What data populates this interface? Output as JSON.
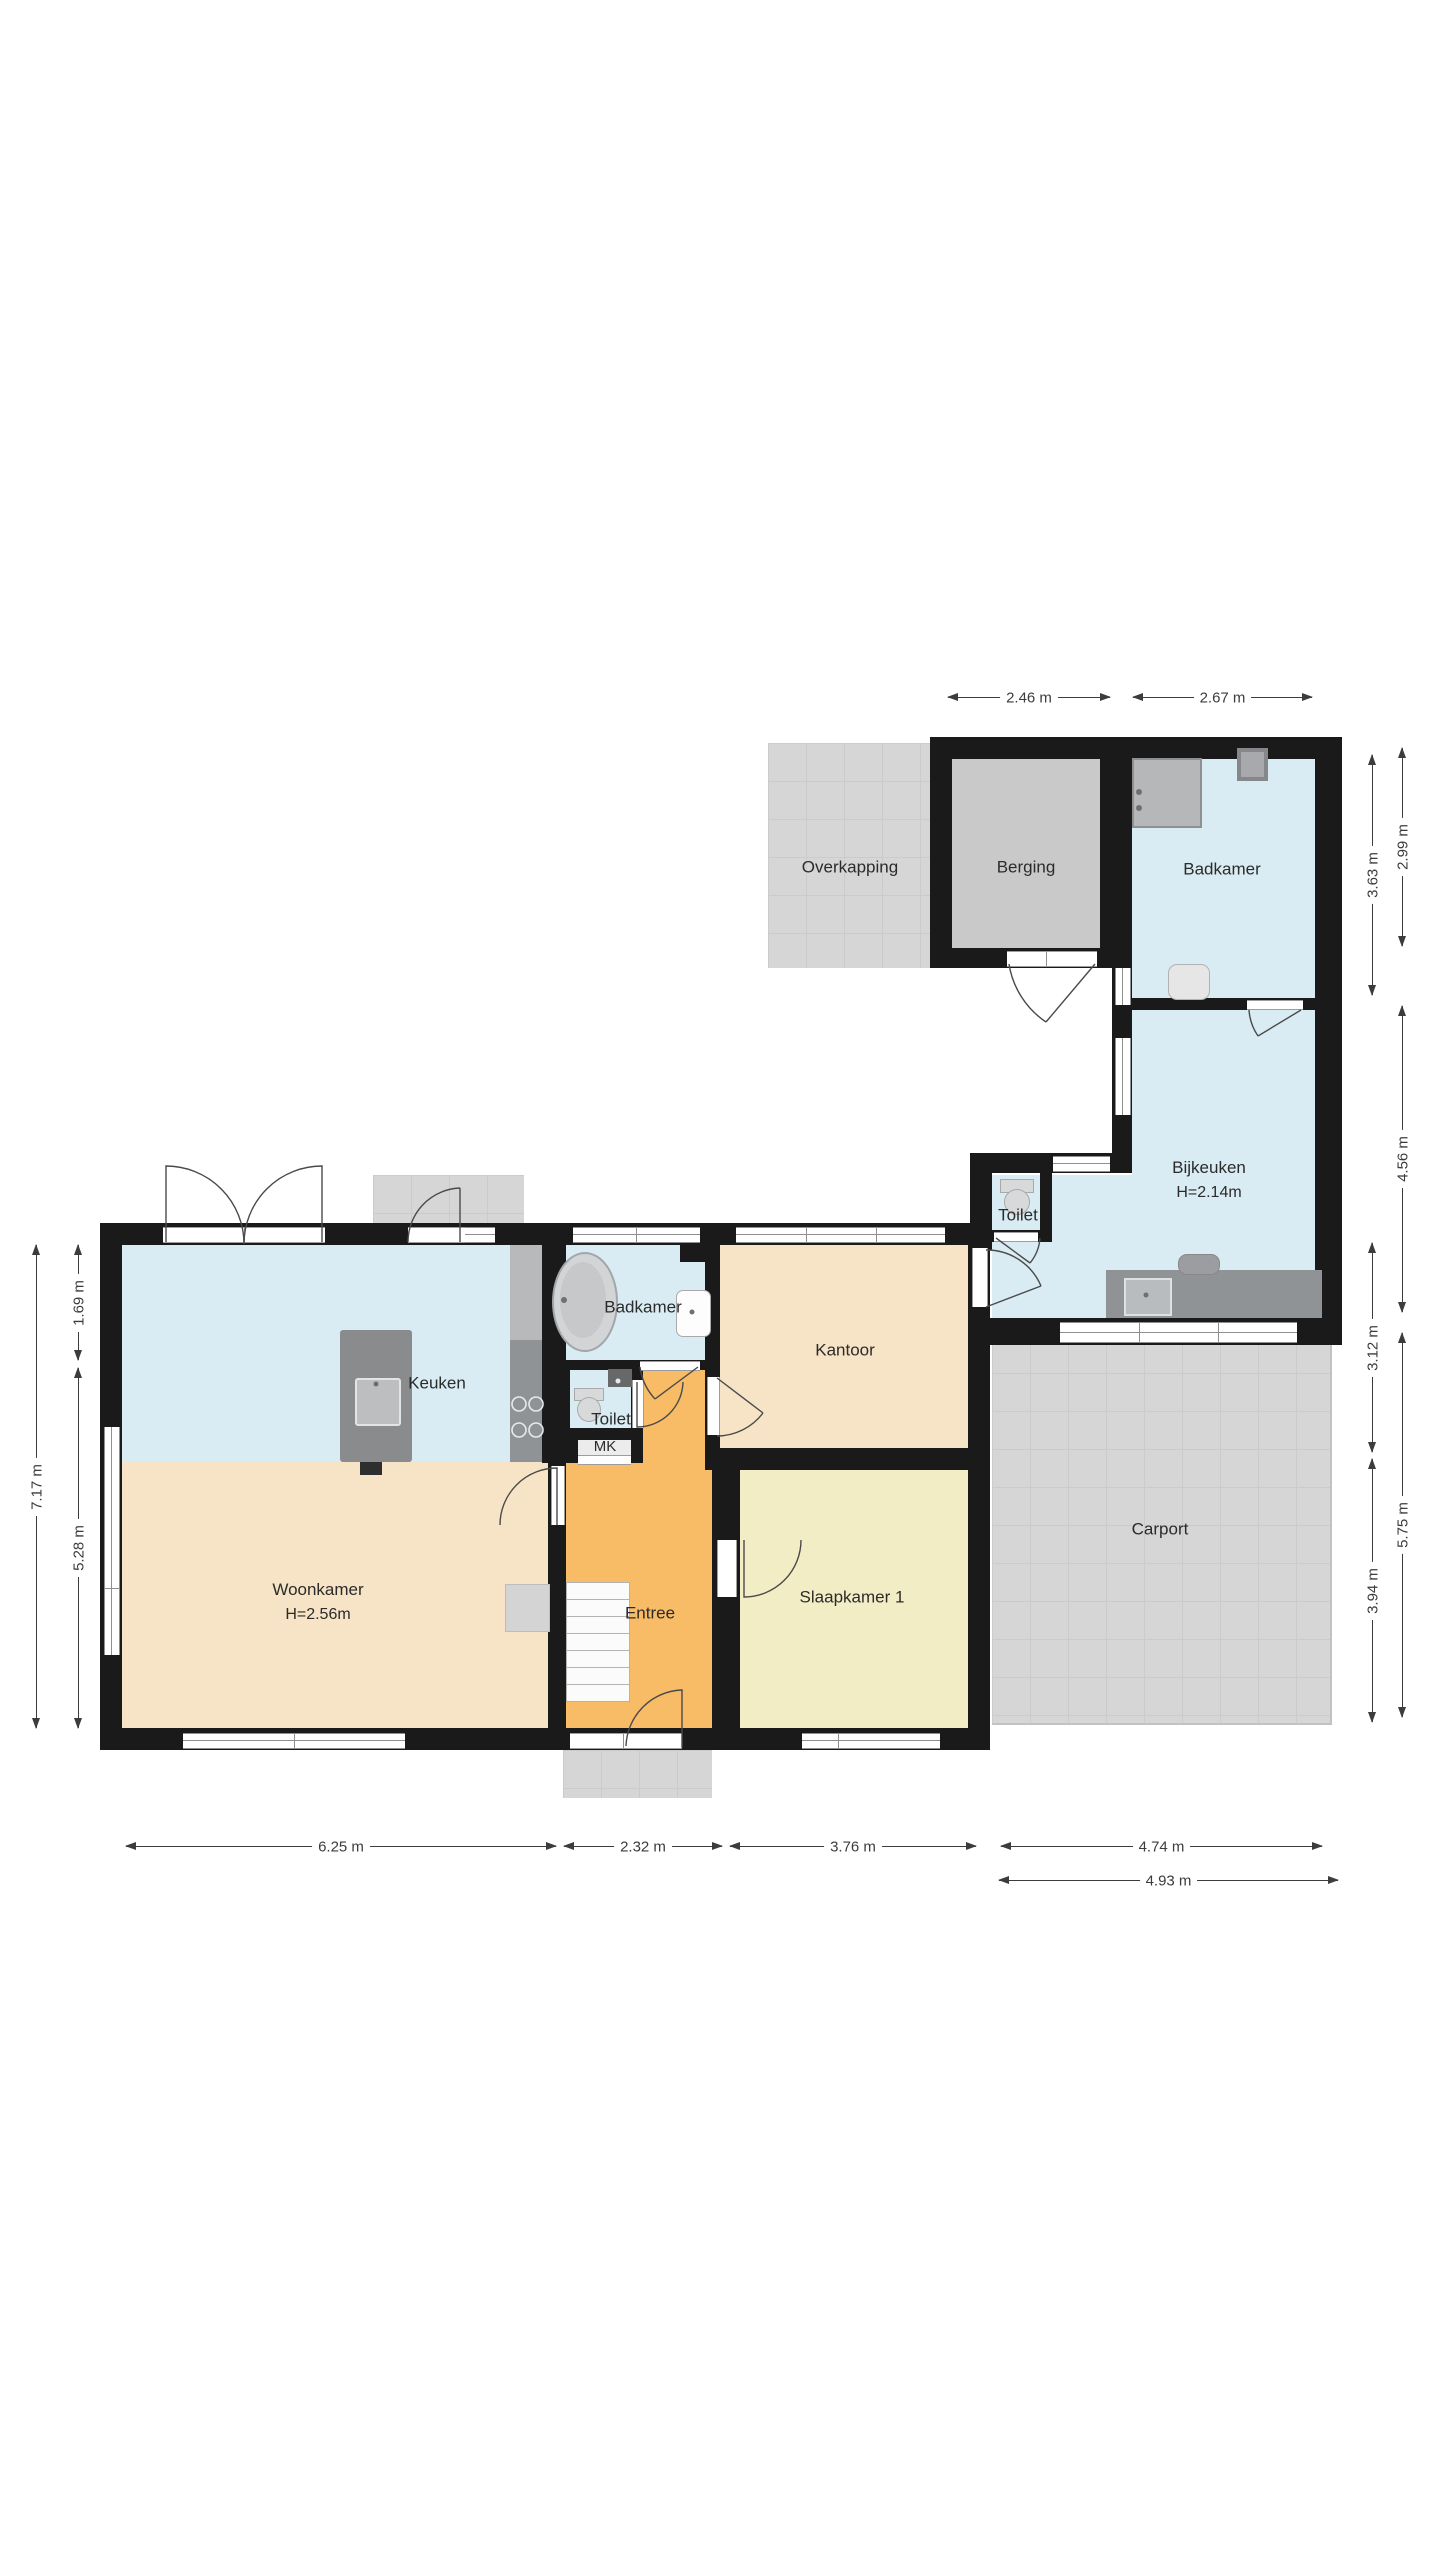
{
  "title": "Floor plan (begane grond)",
  "rooms": {
    "overkapping": {
      "label": "Overkapping"
    },
    "berging": {
      "label": "Berging"
    },
    "badkamer_boven": {
      "label": "Badkamer"
    },
    "bijkeuken": {
      "label": "Bijkeuken",
      "height_note": "H=2.14m"
    },
    "toilet_bijkeuken": {
      "label": "Toilet"
    },
    "keuken": {
      "label": "Keuken"
    },
    "badkamer": {
      "label": "Badkamer"
    },
    "toilet": {
      "label": "Toilet"
    },
    "mk": {
      "label": "MK"
    },
    "kantoor": {
      "label": "Kantoor"
    },
    "woonkamer": {
      "label": "Woonkamer",
      "height_note": "H=2.56m"
    },
    "entree": {
      "label": "Entree"
    },
    "slaapkamer1": {
      "label": "Slaapkamer 1"
    },
    "carport": {
      "label": "Carport"
    }
  },
  "dimensions": {
    "top": [
      {
        "value": "2.46 m"
      },
      {
        "value": "2.67 m"
      }
    ],
    "left": [
      {
        "value": "7.17 m"
      },
      {
        "value": "1.69 m"
      },
      {
        "value": "5.28 m"
      }
    ],
    "right": [
      {
        "value": "3.63 m"
      },
      {
        "value": "2.99 m"
      },
      {
        "value": "4.56 m"
      },
      {
        "value": "3.12 m"
      },
      {
        "value": "5.75 m"
      },
      {
        "value": "3.94 m"
      }
    ],
    "bottom": [
      {
        "value": "6.25 m"
      },
      {
        "value": "2.32 m"
      },
      {
        "value": "3.76 m"
      },
      {
        "value": "4.74 m"
      },
      {
        "value": "4.93 m"
      }
    ]
  },
  "colors": {
    "wall": "#1a1a1a",
    "wet_room_blue": "#d9ecf3",
    "living_peach": "#f7e3c6",
    "entry_orange": "#f8bb66",
    "bedroom_yellow": "#f3edc6",
    "storage_gray": "#c9c9c9",
    "outdoor_tile_gray": "#d6d6d6",
    "counter_gray": "#8f9396",
    "dimension_text": "#3c3c3c"
  }
}
